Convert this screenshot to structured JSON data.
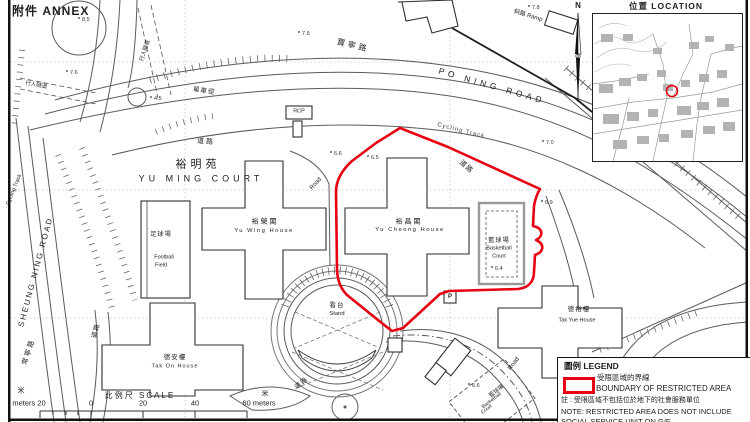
{
  "annex_label": "附件 ANNEX",
  "north_label": "N",
  "location_inset": {
    "title": "位置 LOCATION"
  },
  "estate": {
    "name_zh": "裕明苑",
    "name_en": "YU MING COURT"
  },
  "roads": {
    "po_ning_zh": "寶寧路",
    "po_ning_en": "PO NING ROAD",
    "sheung_ning_en": "SHEUNG NING ROAD",
    "sheung_ning_zh": "常寧路",
    "cycling_track_top": "Cycling Track",
    "cycling_track_left": "Cycling Track",
    "cycle_path_zh": "單車徑",
    "road_zh_top": "道路",
    "road_zh_right": "道路",
    "road_zh_left": "道路",
    "road_zh_bottom": "道路",
    "road_en_inner": "Road",
    "road_en_bottom": "Road",
    "ramp": "斜路 Ramp",
    "tunnel_1": "行人隧道",
    "tunnel_2": "行人隧道",
    "rcp": "RCP"
  },
  "places": {
    "yu_wing_zh": "裕榮閣",
    "yu_wing_en": "Yu Wing House",
    "yu_cheong_zh": "裕昌閣",
    "yu_cheong_en": "Yu Cheong House",
    "basketball_zh": "籃球場",
    "basketball_en1": "Basketball",
    "basketball_en2": "Court",
    "football_zh": "足球場",
    "football_en1": "Football",
    "football_en2": "Field",
    "stand_zh": "看台",
    "stand_en": "Stand",
    "tak_on_zh": "德安樓",
    "tak_on_en": "Tak On House",
    "tak_yue_zh": "德裕樓",
    "tak_yue_en": "Tak Yue House",
    "basketball2_zh": "籃球場",
    "basketball2_en1": "Basketball",
    "basketball2_en2": "Court",
    "parking": "P"
  },
  "spots": [
    "8.5",
    "7.5",
    "7.6",
    "4.5",
    "6.6",
    "6.5",
    "7.0",
    "6.9",
    "6.4",
    "6.6",
    "7.8"
  ],
  "legend": {
    "title": "圖例 LEGEND",
    "item_zh": "受限區域的界線",
    "item_en": "BOUNDARY OF RESTRICTED AREA",
    "note_zh": "註 : 受限區域不包括位於地下的社會服務單位",
    "note_en_line1": "NOTE: RESTRICTED AREA DOES NOT INCLUDE",
    "note_en_line2": "SOCIAL SERVICE UNIT ON G/F"
  },
  "scale_bar": {
    "title": "比例尺 SCALE",
    "unit_left": "米",
    "unit_right": "米",
    "labels": [
      "meters 20",
      "0",
      "20",
      "40",
      "60 meters"
    ]
  },
  "colors": {
    "restricted_boundary_red": "#e60011",
    "map_line_gray": "#5a5a5a",
    "building_line": "#2e2e2e"
  }
}
